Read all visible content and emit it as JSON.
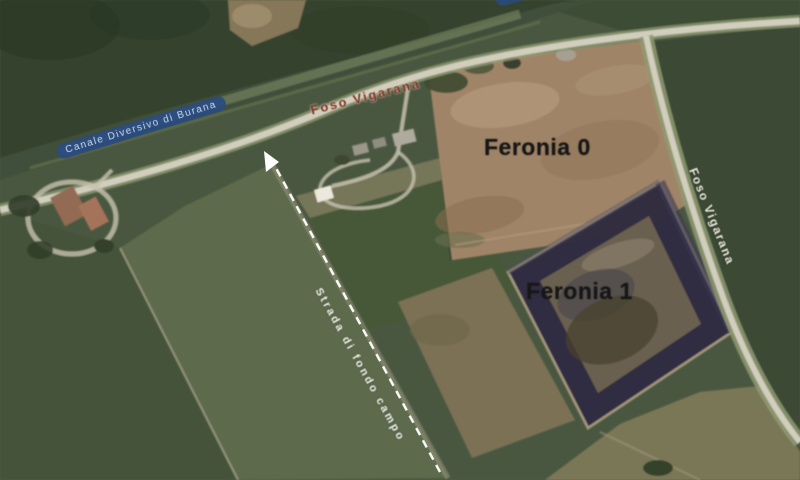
{
  "figure": {
    "type": "satellite-aerial-map",
    "labels": {
      "canal": "Canale Diversivo di Burana",
      "main_road": "Foso Vigarana",
      "east_road": "Foso Vigarana",
      "site0": "Feronia 0",
      "site1": "Feronia 1",
      "track_road": "Strada di fondo campo"
    },
    "annotations": {
      "arrow_icon": "direction-arrow"
    },
    "colors": {
      "base_green": "#4e5b43",
      "trees_dark": "#35422e",
      "canal_band": "#41503a",
      "field_dark": "#44523b",
      "field_light": "#5d6a4b",
      "field_east": "#3b4a34",
      "field_olive": "#7a7757",
      "landfill_brown": "#a08468",
      "liner_dark": "#2e2c40",
      "liner_inner": "#6b6050",
      "road_light": "#d1cebd",
      "canal_label_bg": "#2a4b82",
      "canal_label_text": "#cfe0f5",
      "road_label_red": "#7b2f22",
      "site_label_black": "#171717",
      "annotation_white": "#ffffff"
    }
  }
}
